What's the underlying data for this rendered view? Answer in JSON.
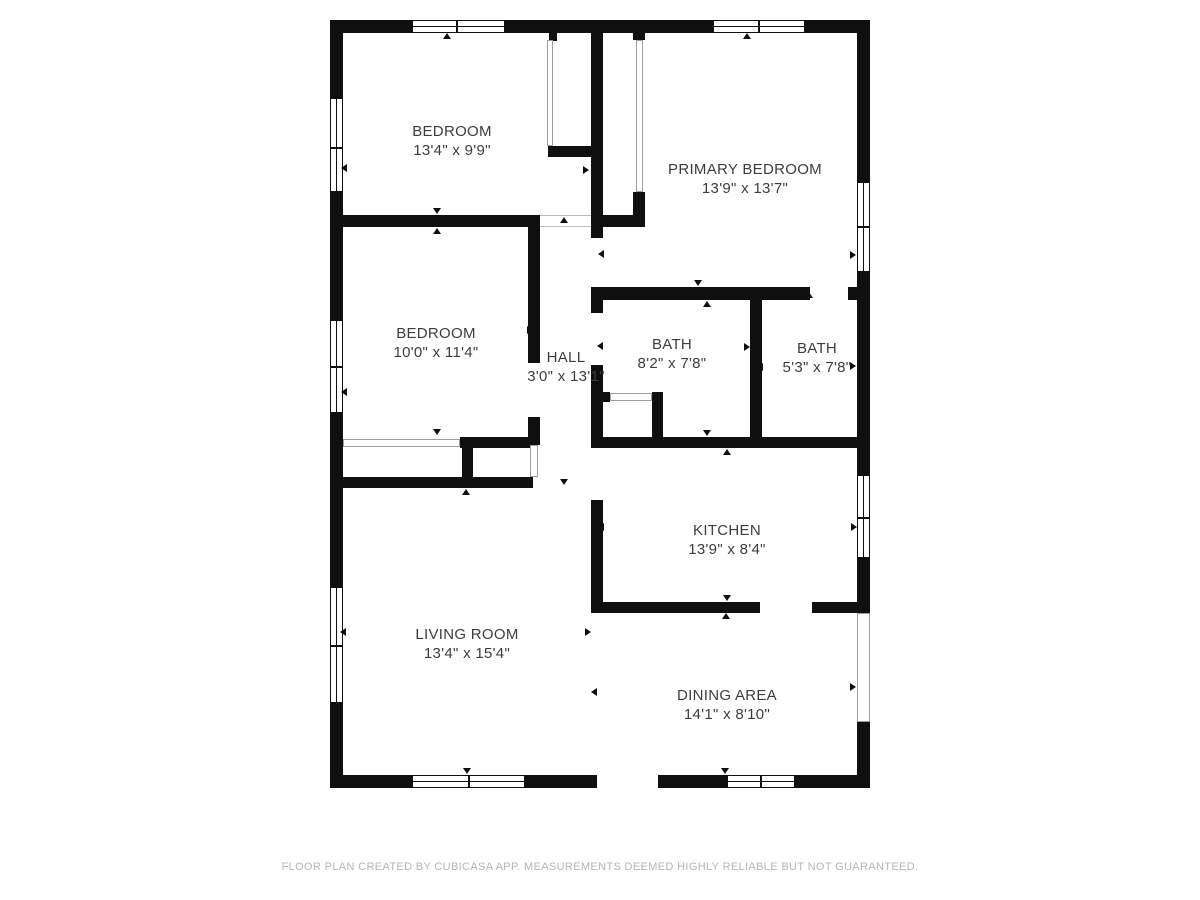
{
  "page": {
    "footer": "FLOOR PLAN CREATED BY CUBICASA APP. MEASUREMENTS DEEMED HIGHLY RELIABLE BUT NOT GUARANTEED."
  },
  "colors": {
    "wall": "#0f0f0f",
    "label": "#3d3d3d",
    "footer": "#b5b5b5",
    "door_outline": "#9e9e9e"
  },
  "rooms": [
    {
      "id": "bedroom-1",
      "name": "BEDROOM",
      "dims": "13'4\" x 9'9\"",
      "cx": 452,
      "cy": 141
    },
    {
      "id": "primary-bedroom",
      "name": "PRIMARY BEDROOM",
      "dims": "13'9\" x 13'7\"",
      "cx": 745,
      "cy": 179
    },
    {
      "id": "bedroom-2",
      "name": "BEDROOM",
      "dims": "10'0\" x 11'4\"",
      "cx": 436,
      "cy": 343
    },
    {
      "id": "hall",
      "name": "HALL",
      "dims": "3'0\" x 13'1\"",
      "cx": 566,
      "cy": 367
    },
    {
      "id": "bath-1",
      "name": "BATH",
      "dims": "8'2\" x 7'8\"",
      "cx": 672,
      "cy": 354
    },
    {
      "id": "bath-2",
      "name": "BATH",
      "dims": "5'3\" x 7'8\"",
      "cx": 817,
      "cy": 358
    },
    {
      "id": "kitchen",
      "name": "KITCHEN",
      "dims": "13'9\" x 8'4\"",
      "cx": 727,
      "cy": 540
    },
    {
      "id": "living-room",
      "name": "LIVING ROOM",
      "dims": "13'4\" x 15'4\"",
      "cx": 467,
      "cy": 644
    },
    {
      "id": "dining-area",
      "name": "DINING AREA",
      "dims": "14'1\" x 8'10\"",
      "cx": 727,
      "cy": 705
    }
  ],
  "plan": {
    "walls": [
      {
        "name": "exterior-top-wall",
        "x": 330,
        "y": 20,
        "w": 540,
        "h": 13
      },
      {
        "name": "exterior-left-wall",
        "x": 330,
        "y": 20,
        "w": 13,
        "h": 768
      },
      {
        "name": "exterior-right-wall",
        "x": 857,
        "y": 20,
        "w": 13,
        "h": 768
      },
      {
        "name": "exterior-bottom-wall-left",
        "x": 330,
        "y": 775,
        "w": 267,
        "h": 13
      },
      {
        "name": "exterior-bottom-wall-right",
        "x": 658,
        "y": 775,
        "w": 212,
        "h": 13
      },
      {
        "name": "bedroom1-bottom-wall",
        "x": 343,
        "y": 215,
        "w": 197,
        "h": 12
      },
      {
        "name": "hall-right-wall-upper",
        "x": 591,
        "y": 33,
        "w": 12,
        "h": 205
      },
      {
        "name": "hall-right-wall-mid",
        "x": 591,
        "y": 287,
        "w": 12,
        "h": 26
      },
      {
        "name": "hall-right-wall-lower",
        "x": 591,
        "y": 365,
        "w": 12,
        "h": 83
      },
      {
        "name": "kitchen-left-wall",
        "x": 591,
        "y": 500,
        "w": 12,
        "h": 113
      },
      {
        "name": "bedroom1-closet-stub",
        "x": 549,
        "y": 33,
        "w": 8,
        "h": 8
      },
      {
        "name": "bedroom1-closet-bottom",
        "x": 548,
        "y": 146,
        "w": 55,
        "h": 11
      },
      {
        "name": "primary-closet-stub",
        "x": 633,
        "y": 33,
        "w": 12,
        "h": 7
      },
      {
        "name": "primary-closet-right-low",
        "x": 633,
        "y": 192,
        "w": 12,
        "h": 35
      },
      {
        "name": "primary-closet-bottom",
        "x": 591,
        "y": 215,
        "w": 54,
        "h": 12
      },
      {
        "name": "primary-bath-wall",
        "x": 591,
        "y": 287,
        "w": 219,
        "h": 13
      },
      {
        "name": "primary-bath-wall-stub",
        "x": 848,
        "y": 287,
        "w": 9,
        "h": 13
      },
      {
        "name": "bath-divider-wall",
        "x": 750,
        "y": 300,
        "w": 12,
        "h": 148
      },
      {
        "name": "bath-kitchen-wall",
        "x": 591,
        "y": 437,
        "w": 277,
        "h": 11
      },
      {
        "name": "bath1-closet-stub",
        "x": 597,
        "y": 392,
        "w": 13,
        "h": 10
      },
      {
        "name": "bath1-closet-right-wall",
        "x": 652,
        "y": 392,
        "w": 11,
        "h": 56
      },
      {
        "name": "kitchen-bottom-wall-left",
        "x": 591,
        "y": 602,
        "w": 169,
        "h": 11
      },
      {
        "name": "kitchen-bottom-wall-right",
        "x": 812,
        "y": 602,
        "w": 45,
        "h": 11
      },
      {
        "name": "bedroom2-right-wall-upper",
        "x": 528,
        "y": 227,
        "w": 12,
        "h": 136
      },
      {
        "name": "bedroom2-right-wall-lower",
        "x": 528,
        "y": 417,
        "w": 12,
        "h": 28
      },
      {
        "name": "bedroom2-closet-wall",
        "x": 460,
        "y": 437,
        "w": 73,
        "h": 11
      },
      {
        "name": "closet-connector-wall",
        "x": 462,
        "y": 448,
        "w": 11,
        "h": 29
      },
      {
        "name": "living-room-top-wall",
        "x": 343,
        "y": 477,
        "w": 190,
        "h": 11
      }
    ],
    "windows": [
      {
        "name": "window-top-bedroom1",
        "x": 412,
        "y": 20,
        "w": 93,
        "h": 13,
        "orient": "h",
        "dividers": [
          456
        ]
      },
      {
        "name": "window-top-primary",
        "x": 713,
        "y": 20,
        "w": 92,
        "h": 13,
        "orient": "h",
        "dividers": [
          758
        ]
      },
      {
        "name": "window-left-bedroom1",
        "x": 330,
        "y": 98,
        "w": 13,
        "h": 94,
        "orient": "v",
        "dividers": [
          147
        ]
      },
      {
        "name": "window-left-bedroom2",
        "x": 330,
        "y": 320,
        "w": 13,
        "h": 93,
        "orient": "v",
        "dividers": [
          366
        ]
      },
      {
        "name": "window-left-living",
        "x": 330,
        "y": 587,
        "w": 13,
        "h": 116,
        "orient": "v",
        "dividers": [
          645
        ]
      },
      {
        "name": "window-right-primary",
        "x": 857,
        "y": 182,
        "w": 13,
        "h": 90,
        "orient": "v",
        "dividers": [
          226
        ]
      },
      {
        "name": "window-right-kitchen",
        "x": 857,
        "y": 475,
        "w": 13,
        "h": 83,
        "orient": "v",
        "dividers": [
          517
        ]
      },
      {
        "name": "window-bottom-living",
        "x": 412,
        "y": 775,
        "w": 113,
        "h": 13,
        "orient": "h",
        "dividers": [
          468
        ]
      },
      {
        "name": "window-bottom-dining",
        "x": 727,
        "y": 775,
        "w": 68,
        "h": 13,
        "orient": "h",
        "dividers": [
          760
        ]
      }
    ],
    "sliders": [
      {
        "name": "bedroom1-closet-door",
        "x": 547,
        "y": 40,
        "w": 6,
        "h": 106
      },
      {
        "name": "primary-closet-door",
        "x": 636,
        "y": 40,
        "w": 7,
        "h": 152
      },
      {
        "name": "bedroom2-closet-doors",
        "x": 343,
        "y": 439,
        "w": 117,
        "h": 8
      },
      {
        "name": "bath1-closet-door",
        "x": 610,
        "y": 393,
        "w": 42,
        "h": 8
      },
      {
        "name": "hall-closet-opening",
        "x": 530,
        "y": 445,
        "w": 8,
        "h": 32
      },
      {
        "name": "dining-slider-door",
        "x": 857,
        "y": 613,
        "w": 13,
        "h": 109
      }
    ],
    "openings": [
      {
        "name": "bedroom1-door-opening",
        "x": 540,
        "y": 215,
        "w": 51,
        "h": 12
      }
    ],
    "markers": [
      {
        "x": 447,
        "y": 36,
        "dir": "up"
      },
      {
        "x": 344,
        "y": 168,
        "dir": "left"
      },
      {
        "x": 586,
        "y": 170,
        "dir": "right"
      },
      {
        "x": 437,
        "y": 211,
        "dir": "down"
      },
      {
        "x": 747,
        "y": 36,
        "dir": "up"
      },
      {
        "x": 601,
        "y": 254,
        "dir": "left"
      },
      {
        "x": 853,
        "y": 255,
        "dir": "right"
      },
      {
        "x": 698,
        "y": 283,
        "dir": "down"
      },
      {
        "x": 437,
        "y": 231,
        "dir": "up"
      },
      {
        "x": 344,
        "y": 392,
        "dir": "left"
      },
      {
        "x": 530,
        "y": 330,
        "dir": "right"
      },
      {
        "x": 437,
        "y": 432,
        "dir": "down"
      },
      {
        "x": 564,
        "y": 220,
        "dir": "up"
      },
      {
        "x": 536,
        "y": 356,
        "dir": "left"
      },
      {
        "x": 564,
        "y": 482,
        "dir": "down"
      },
      {
        "x": 707,
        "y": 304,
        "dir": "up"
      },
      {
        "x": 600,
        "y": 346,
        "dir": "left"
      },
      {
        "x": 747,
        "y": 347,
        "dir": "right"
      },
      {
        "x": 707,
        "y": 433,
        "dir": "down"
      },
      {
        "x": 809,
        "y": 295,
        "dir": "up"
      },
      {
        "x": 760,
        "y": 367,
        "dir": "left"
      },
      {
        "x": 853,
        "y": 366,
        "dir": "right"
      },
      {
        "x": 812,
        "y": 441,
        "dir": "down"
      },
      {
        "x": 727,
        "y": 452,
        "dir": "up"
      },
      {
        "x": 601,
        "y": 527,
        "dir": "left"
      },
      {
        "x": 854,
        "y": 527,
        "dir": "right"
      },
      {
        "x": 727,
        "y": 598,
        "dir": "down"
      },
      {
        "x": 466,
        "y": 492,
        "dir": "up"
      },
      {
        "x": 343,
        "y": 632,
        "dir": "left"
      },
      {
        "x": 588,
        "y": 632,
        "dir": "right"
      },
      {
        "x": 467,
        "y": 771,
        "dir": "down"
      },
      {
        "x": 726,
        "y": 616,
        "dir": "up"
      },
      {
        "x": 594,
        "y": 692,
        "dir": "left"
      },
      {
        "x": 853,
        "y": 687,
        "dir": "right"
      },
      {
        "x": 725,
        "y": 771,
        "dir": "down"
      }
    ]
  }
}
